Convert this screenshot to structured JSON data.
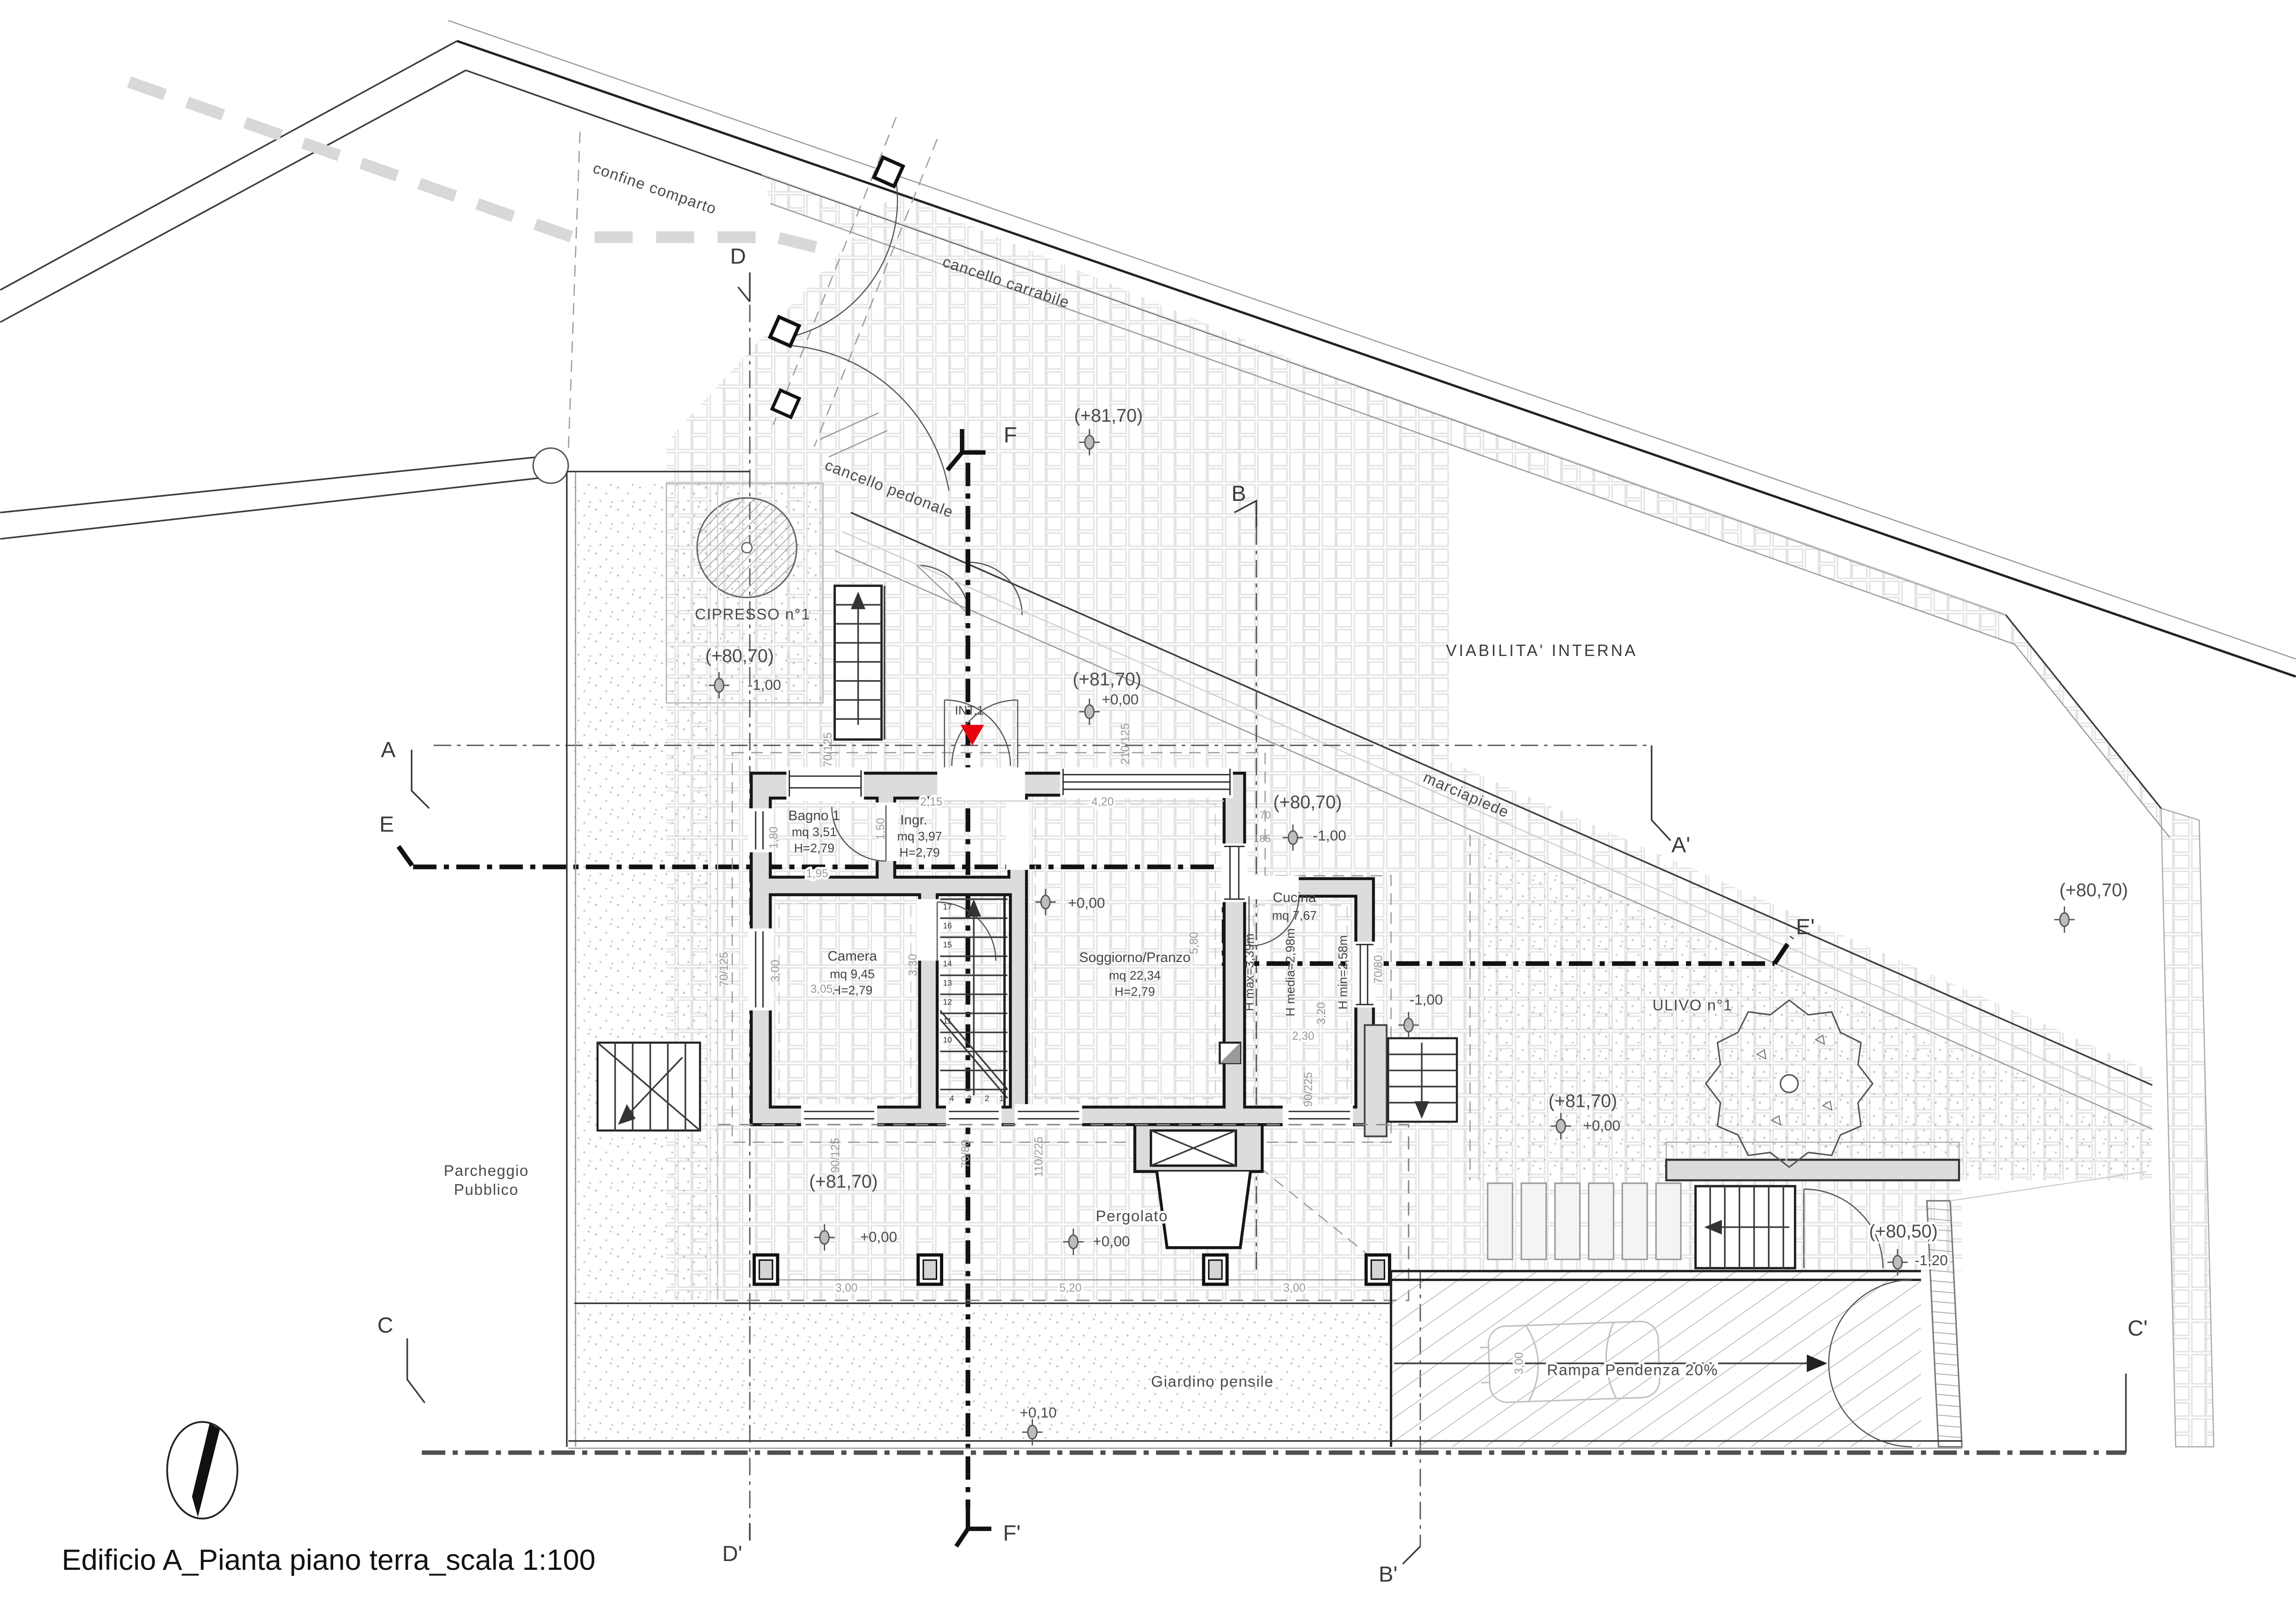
{
  "title": "Edificio A_Pianta piano terra_scala 1:100",
  "labels": {
    "confine": "confine  comparto",
    "carrabile": "cancello  carrabile",
    "pedonale": "cancello  pedonale",
    "viabilita": "VIABILITA'  INTERNA",
    "marciapiede": "marciapiede",
    "cipresso": "CIPRESSO  n°1",
    "ulivo": "ULIVO  n°1",
    "parcheggio1": "Parcheggio",
    "parcheggio2": "Pubblico",
    "pergolato": "Pergolato",
    "giardino": "Giardino  pensile",
    "rampa": "Rampa  Pendenza  20%",
    "int1": "INT.1"
  },
  "rooms": {
    "bagno": [
      "Bagno  1",
      "mq  3,51",
      "H=2,79"
    ],
    "ingresso": [
      "Ingr.",
      "mq  3,97",
      "H=2,79"
    ],
    "camera": [
      "Camera",
      "mq  9,45",
      "H=2,79"
    ],
    "soggiorno": [
      "Soggiorno/Pranzo",
      "mq  22,34",
      "H=2,79"
    ],
    "cucina": [
      "Cucina",
      "mq  7,67"
    ],
    "cucina_h": [
      "H  max=3,39m",
      "H  media=2,98m",
      "H  min=2,58m"
    ]
  },
  "quote": {
    "road": {
      "q": "(+81,70)"
    },
    "court": {
      "q": "(+81,70)",
      "s": "+0,00"
    },
    "cipresso": {
      "q": "(+80,70)",
      "s": "-1,00"
    },
    "ne": {
      "q": "(+80,70)",
      "s": "-1,00"
    },
    "est": {
      "q": "(+80,70)"
    },
    "ulivo": {
      "q": "(+81,70)",
      "s": "+0,00"
    },
    "parcheggio": {
      "q": "(+81,70)",
      "s": "+0,00"
    },
    "pergola": {
      "s": "+0,00"
    },
    "soggiorno": {
      "s": "+0,00"
    },
    "scala_est": {
      "s": "-1,00"
    },
    "se": {
      "q": "(+80,50)",
      "s": "-1,20"
    },
    "giardino": {
      "s": "+0,10"
    }
  },
  "sections": {
    "A": "A",
    "A1": "A'",
    "B": "B",
    "B1": "B'",
    "C": "C",
    "C1": "C'",
    "D": "D",
    "D1": "D'",
    "E": "E",
    "E1": "E'",
    "F": "F",
    "F1": "F'"
  },
  "dims": {
    "d215": "2,15",
    "d420": "4,20",
    "d195": "1,95",
    "d180": "1,80",
    "d150": "1,50",
    "d300a": "3,00",
    "d330": "3,30",
    "d305": "3,05",
    "d580": "5,80",
    "d230": "2,30",
    "d320": "3,20",
    "d210_125": "210/125",
    "d70_125a": "70/125",
    "d70_125b": "70/125",
    "d90_125": "90/125",
    "d70_80a": "70/80",
    "d110_225": "110/225",
    "d90_225": "90/225",
    "d70_80b": "70/80",
    "d70": "70",
    "d185": "185",
    "p300a": "3,00",
    "p520": "5,20",
    "p300b": "3,00",
    "r300": "3,00"
  },
  "stairs": {
    "n17": "17",
    "n16": "16",
    "n15": "15",
    "n14": "14",
    "n13": "13",
    "n12": "12",
    "n11": "11",
    "n10": "10",
    "n4": "4",
    "n3": "3",
    "n2": "2",
    "n1": "1"
  }
}
